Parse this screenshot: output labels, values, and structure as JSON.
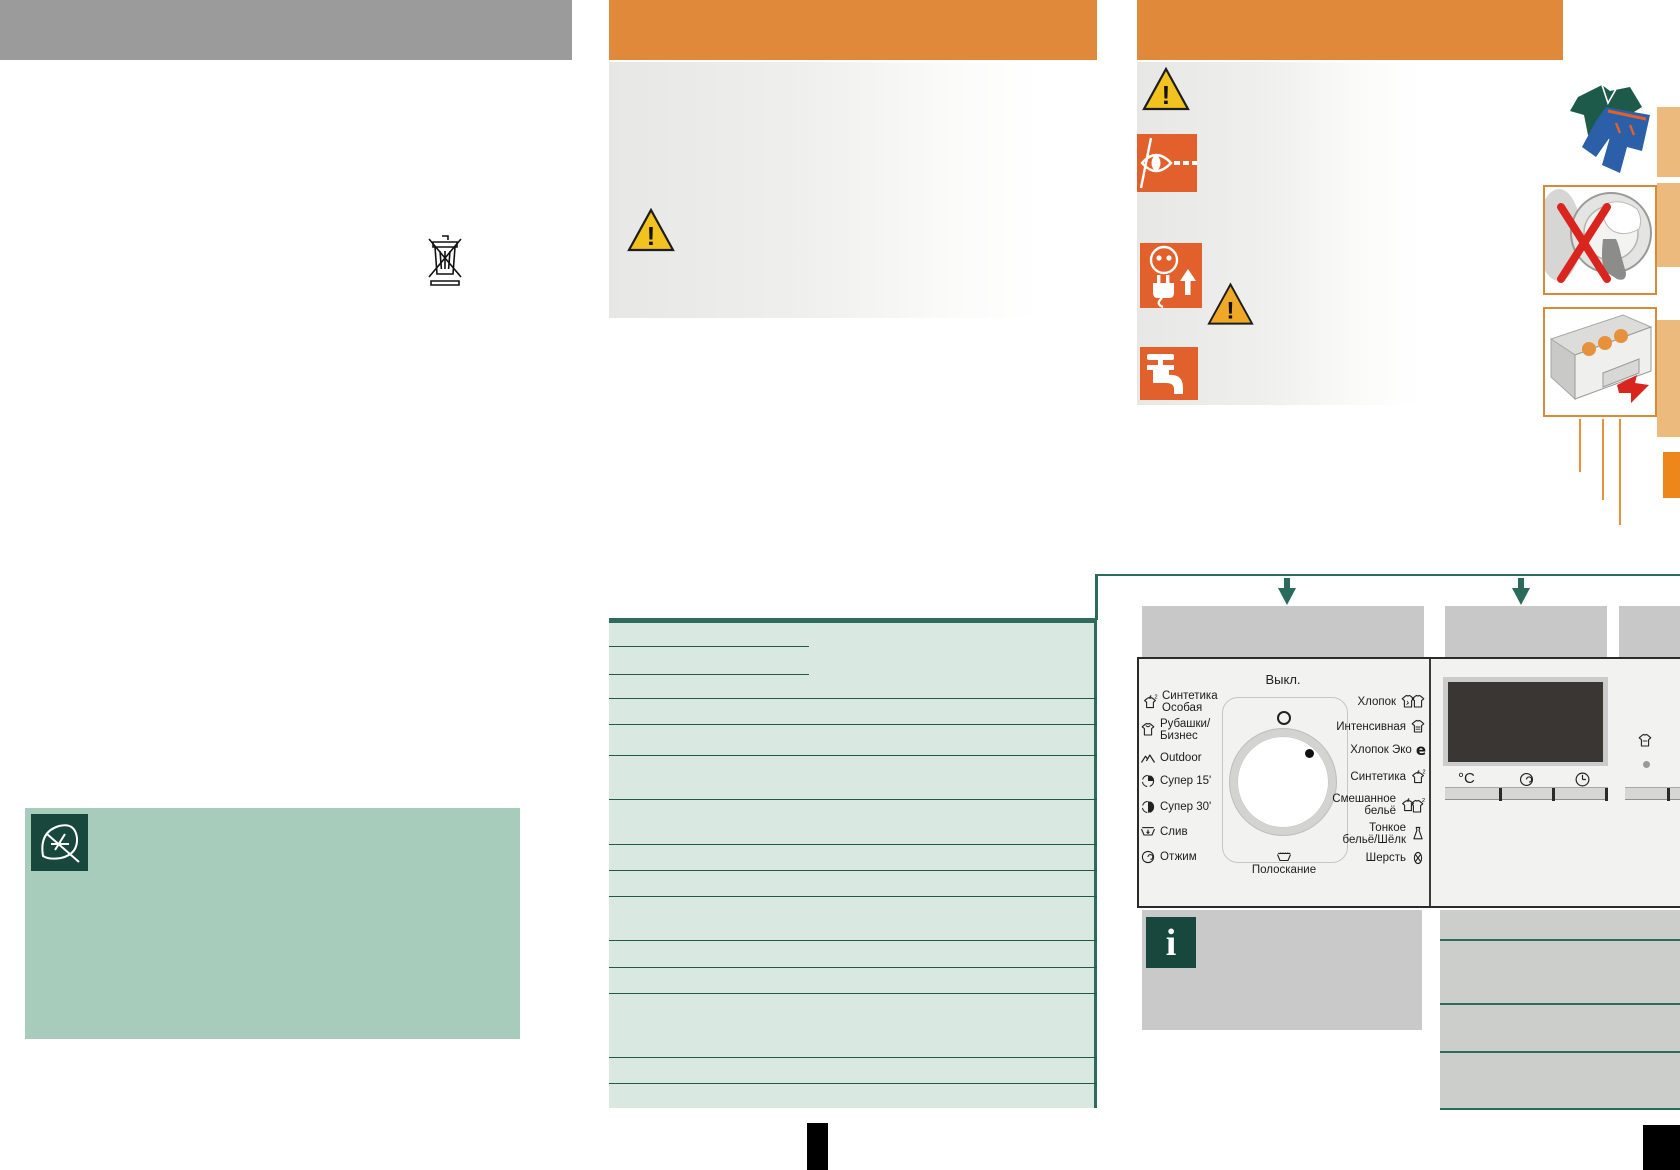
{
  "control_panel": {
    "off_label": "Выкл.",
    "rinse_label": "Полоскание",
    "temperature_unit": "°C",
    "programs_left": [
      {
        "label_line1": "Синтетика",
        "label_line2": "Особая",
        "icon": "synthetics-special-icon"
      },
      {
        "label_line1": "Рубашки/",
        "label_line2": "Бизнес",
        "icon": "shirts-business-icon"
      },
      {
        "label_line1": "Outdoor",
        "label_line2": "",
        "icon": "outdoor-icon"
      },
      {
        "label_line1": "Супер 15'",
        "label_line2": "",
        "icon": "super-15-icon"
      },
      {
        "label_line1": "Супер 30'",
        "label_line2": "",
        "icon": "super-30-icon"
      },
      {
        "label_line1": "Слив",
        "label_line2": "",
        "icon": "drain-icon"
      },
      {
        "label_line1": "Отжим",
        "label_line2": "",
        "icon": "spin-icon"
      }
    ],
    "programs_right": [
      {
        "label_line1": "Хлопок",
        "label_line2": "",
        "icon": "cotton-icon"
      },
      {
        "label_line1": "Интенсивная",
        "label_line2": "",
        "icon": "intensive-icon"
      },
      {
        "label_line1": "Хлопок Эко",
        "label_line2": "",
        "icon": "cotton-eco-icon"
      },
      {
        "label_line1": "Синтетика",
        "label_line2": "",
        "icon": "synthetics-icon"
      },
      {
        "label_line1": "Смешанное",
        "label_line2": "бельё",
        "icon": "mixed-laundry-icon"
      },
      {
        "label_line1": "Тонкое",
        "label_line2": "бельё/Шёлк",
        "icon": "delicates-silk-icon"
      },
      {
        "label_line1": "Шерсть",
        "label_line2": "",
        "icon": "wool-icon"
      }
    ]
  },
  "icons": {
    "info_glyph": "i",
    "eco_glyph": "e",
    "warning_glyph": "!",
    "weee_bin_icon": "crossed-out-wheeled-bin",
    "eco_leaf_icon": "leaf",
    "eye_caution_icon": "eye-with-dashed-line",
    "unplug_icon": "plug-and-socket-arrow",
    "water_tap_icon": "water-tap",
    "rinse_icon": "tub-with-water",
    "spin_speed_icon": "spin-spiral",
    "time_icon": "clock"
  },
  "colors": {
    "orange_header": "#E0893A",
    "orange_icon": "#E2602C",
    "orange_light": "#EDBA7D",
    "teal_dark": "#2A6B5B",
    "table_green": "#D9E8E1",
    "sage_green": "#A7CCBC",
    "info_green": "#17473D",
    "warning_yellow": "#F2C21E",
    "warning_orange": "#F0A827",
    "gray_header": "#9B9B9B",
    "display_dark": "#3A3633",
    "alert_red": "#D9251D"
  }
}
